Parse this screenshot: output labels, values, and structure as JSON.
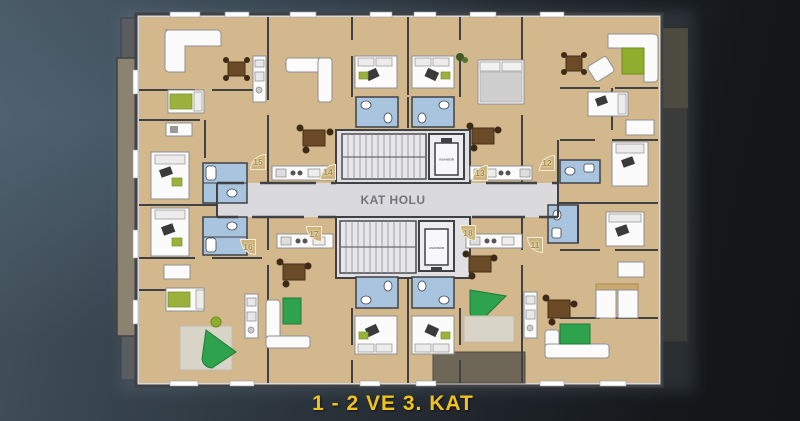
{
  "caption": {
    "text": "1 - 2 VE 3. KAT"
  },
  "hall": {
    "label": "KAT HOLU"
  },
  "core": {
    "elevator_top": "ASANSÖR",
    "elevator_bottom": "ASANSÖR"
  },
  "apartments": [
    {
      "number": "15",
      "row": "top",
      "x": 258,
      "y": 162
    },
    {
      "number": "14",
      "row": "top",
      "x": 328,
      "y": 172
    },
    {
      "number": "13",
      "row": "top",
      "x": 480,
      "y": 173
    },
    {
      "number": "12",
      "row": "top",
      "x": 547,
      "y": 163
    },
    {
      "number": "16",
      "row": "bottom",
      "x": 248,
      "y": 247
    },
    {
      "number": "17",
      "row": "bottom",
      "x": 314,
      "y": 234
    },
    {
      "number": "18",
      "row": "bottom",
      "x": 468,
      "y": 233
    },
    {
      "number": "11",
      "row": "bottom",
      "x": 535,
      "y": 245
    }
  ],
  "colors": {
    "background_left": "#46555F",
    "background_right": "#131517",
    "floor_tan": "#D2B88C",
    "hall_gray": "#DADADC",
    "wall_dark": "#3F4145",
    "bathroom_blue": "#A9C4DE",
    "balcony_olive": "#8B8270",
    "terrace_dark": "#6E6758",
    "furniture_green": "#2FA24D",
    "table_olive_green": "#8FAE2E",
    "desk_brown": "#6B4A28",
    "caption_yellow": "#F0C31C",
    "badge_tan": "#CDB47C"
  }
}
